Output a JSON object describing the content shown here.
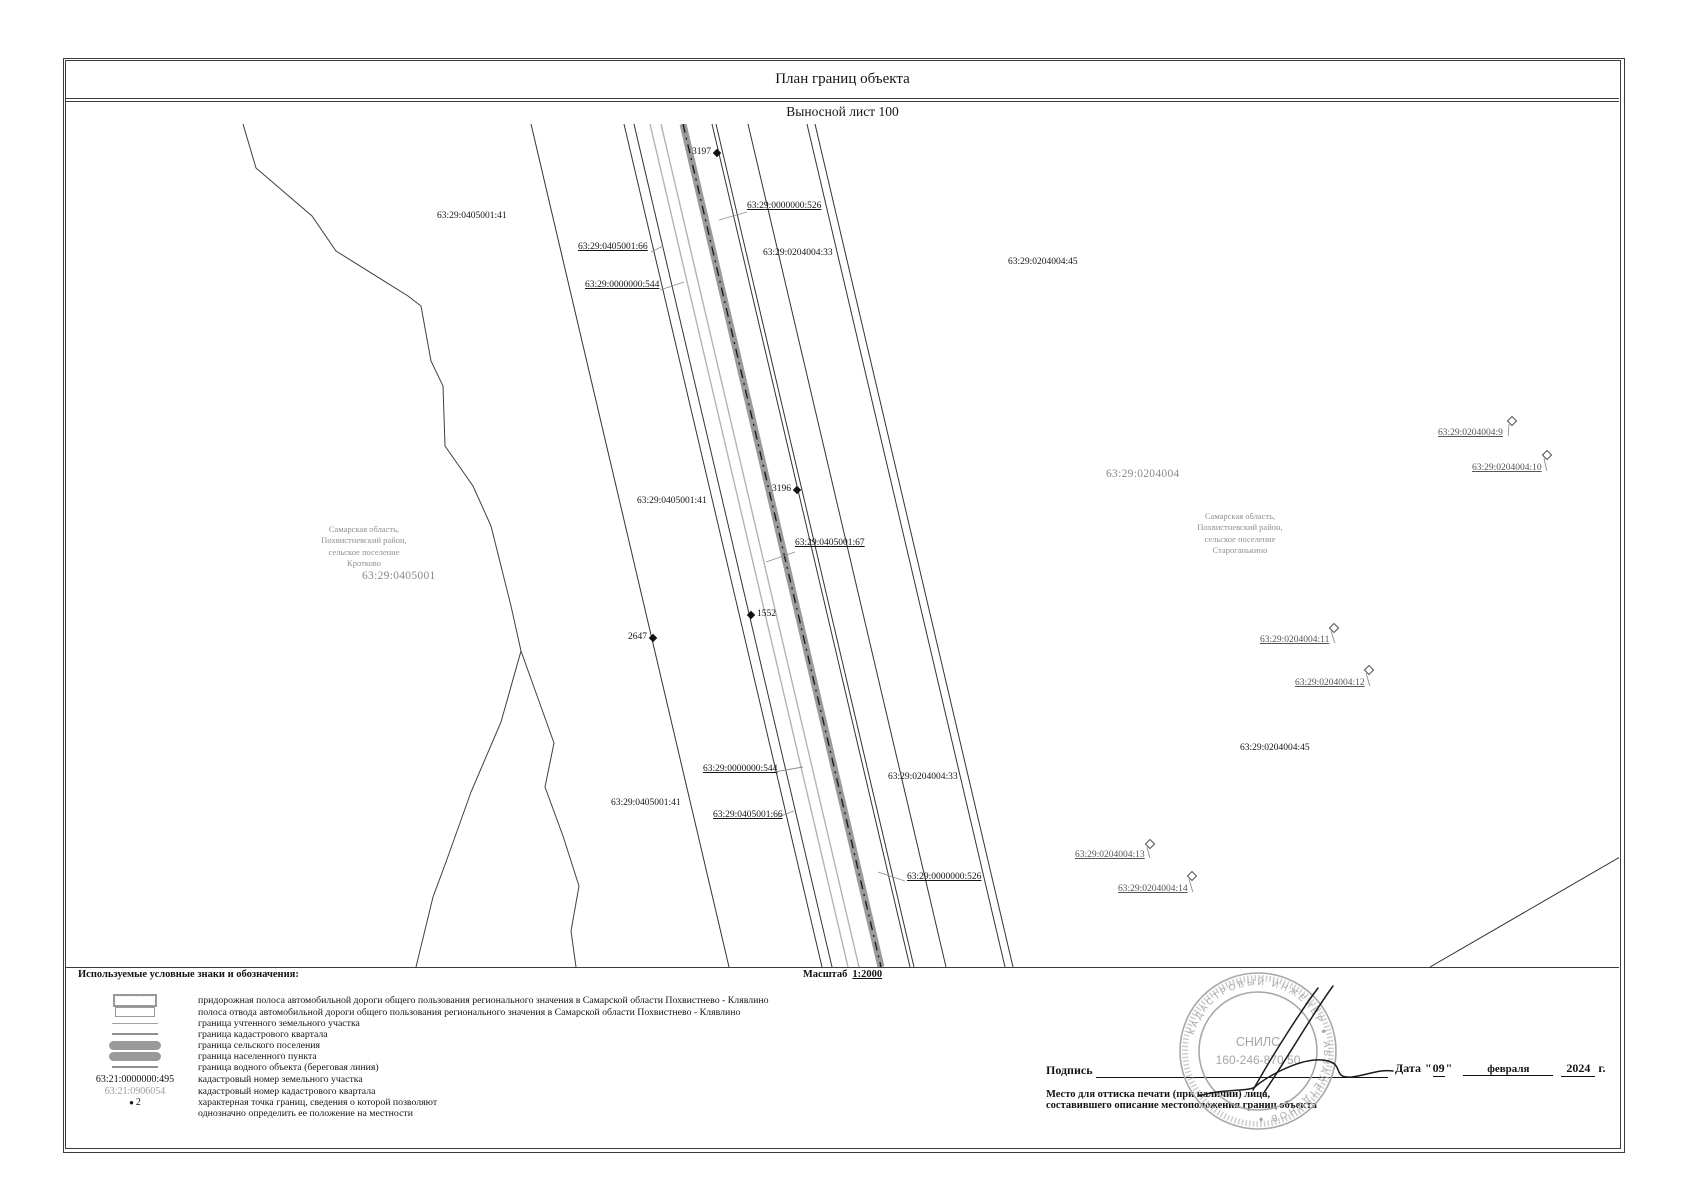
{
  "header": {
    "title": "План границ объекта",
    "subtitle": "Выносной лист 100"
  },
  "map": {
    "scale_label": "Масштаб",
    "scale_value": "1:2000",
    "quarter_labels": [
      {
        "text": "63:29:0405001",
        "x": 362,
        "y": 570
      },
      {
        "text": "63:29:0204004",
        "x": 1106,
        "y": 468
      }
    ],
    "region_labels": [
      {
        "cx": 364,
        "y": 524,
        "lines": [
          "Самарская область,",
          "Похвистневский район,",
          "сельское поселение",
          "Кротково"
        ]
      },
      {
        "cx": 1240,
        "y": 511,
        "lines": [
          "Самарская область,",
          "Похвистневский район,",
          "сельское поселение",
          "Староганькино"
        ]
      }
    ],
    "parcel_labels": [
      {
        "text": "63:29:0405001:41",
        "x": 437,
        "y": 211
      },
      {
        "text": "63:29:0000000:526",
        "x": 747,
        "y": 201,
        "u": 1,
        "leader": [
          747,
          212,
          719,
          220
        ]
      },
      {
        "text": "63:29:0204004:33",
        "x": 763,
        "y": 248
      },
      {
        "text": "63:29:0405001:66",
        "x": 578,
        "y": 242,
        "u": 1,
        "leader": [
          651,
          252,
          663,
          246
        ]
      },
      {
        "text": "63:29:0000000:544",
        "x": 585,
        "y": 280,
        "u": 1,
        "leader": [
          660,
          290,
          684,
          282
        ]
      },
      {
        "text": "63:29:0204004:45",
        "x": 1008,
        "y": 257
      },
      {
        "text": "63:29:0405001:41",
        "x": 637,
        "y": 496
      },
      {
        "text": "63:29:0405001:67",
        "x": 795,
        "y": 538,
        "u": 1,
        "leader": [
          795,
          552,
          766,
          562
        ]
      },
      {
        "text": "63:29:0000000:544",
        "x": 703,
        "y": 764,
        "u": 1,
        "leader": [
          774,
          772,
          803,
          767
        ]
      },
      {
        "text": "63:29:0204004:33",
        "x": 888,
        "y": 772
      },
      {
        "text": "63:29:0405001:41",
        "x": 611,
        "y": 798
      },
      {
        "text": "63:29:0405001:66",
        "x": 713,
        "y": 810,
        "u": 1,
        "leader": [
          778,
          817,
          794,
          811
        ]
      },
      {
        "text": "63:29:0000000:526",
        "x": 907,
        "y": 872,
        "u": 1,
        "leader": [
          905,
          881,
          878,
          872
        ]
      },
      {
        "text": "63:29:0204004:45",
        "x": 1240,
        "y": 743
      }
    ],
    "point_markers": [
      {
        "label": "3197",
        "x": 717,
        "y": 153,
        "side": "left"
      },
      {
        "label": "3196",
        "x": 797,
        "y": 490,
        "side": "left"
      },
      {
        "label": "1552",
        "x": 751,
        "y": 615,
        "side": "right"
      },
      {
        "label": "2647",
        "x": 653,
        "y": 638,
        "side": "left"
      }
    ],
    "diamond_markers": [
      {
        "text": "63:29:0204004:9",
        "lx": 1438,
        "ly": 428,
        "dx": 1512,
        "dy": 421
      },
      {
        "text": "63:29:0204004:10",
        "lx": 1472,
        "ly": 463,
        "dx": 1547,
        "dy": 455
      },
      {
        "text": "63:29:0204004:11",
        "lx": 1260,
        "ly": 635,
        "dx": 1334,
        "dy": 628
      },
      {
        "text": "63:29:0204004:12",
        "lx": 1295,
        "ly": 678,
        "dx": 1369,
        "dy": 670
      },
      {
        "text": "63:29:0204004:13",
        "lx": 1075,
        "ly": 850,
        "dx": 1150,
        "dy": 844
      },
      {
        "text": "63:29:0204004:14",
        "lx": 1118,
        "ly": 884,
        "dx": 1192,
        "dy": 876
      }
    ]
  },
  "legend": {
    "heading": "Используемые условные знаки и обозначения:",
    "items": [
      {
        "sym": "rect-dashed",
        "text": "придорожная полоса автомобильной дороги общего пользования регионального значения в Самарской области Похвистнево - Клявлино"
      },
      {
        "sym": "rect",
        "text": "полоса отвода автомобильной дороги общего пользования регионального значения в Самарской области Похвистнево - Клявлино"
      },
      {
        "sym": "line-thin",
        "text": "граница учтенного земельного участка"
      },
      {
        "sym": "line-med",
        "text": "граница кадастрового квартала"
      },
      {
        "sym": "bar",
        "text": "граница сельского поселения"
      },
      {
        "sym": "bar",
        "text": "граница населенного пункта"
      },
      {
        "sym": "line-med",
        "text": "граница водного объекта (береговая линия)"
      },
      {
        "sym": "text-black",
        "symtext": "63:21:0000000:495",
        "text": "кадастровый номер земельного участка"
      },
      {
        "sym": "text-gray",
        "symtext": "63:21:0906054",
        "text": "кадастровый номер кадастрового квартала"
      },
      {
        "sym": "dot",
        "symtext": "2",
        "text": "характерная точка границ, сведения о которой позволяют однозначно определить ее положение на местности",
        "wrap": true,
        "tall": true
      }
    ]
  },
  "signature": {
    "sign_label": "Подпись",
    "date_label": "Дата",
    "quote": "\"",
    "date_day": "09",
    "date_month": "февраля",
    "date_year": "2024",
    "year_suffix": "г.",
    "note_line1": "Место для оттиска печати (при наличии) лица,",
    "note_line2": "составившего описание местоположения границ объекта",
    "stamp": {
      "ring_text": "КАДАСТРОВЫЙ ИНЖЕНЕР ♦ АБЗАЛЕТДИНОВ ♦",
      "inner_line1": "СНИЛС",
      "inner_line2": "160-246-870 50"
    }
  },
  "colors": {
    "frame": "#3c3c3c",
    "road-band": "#9a9a9a",
    "gray-line": "#b3b3b3",
    "muted-text": "#8f8f8f",
    "stamp": "#a6a6a6"
  }
}
